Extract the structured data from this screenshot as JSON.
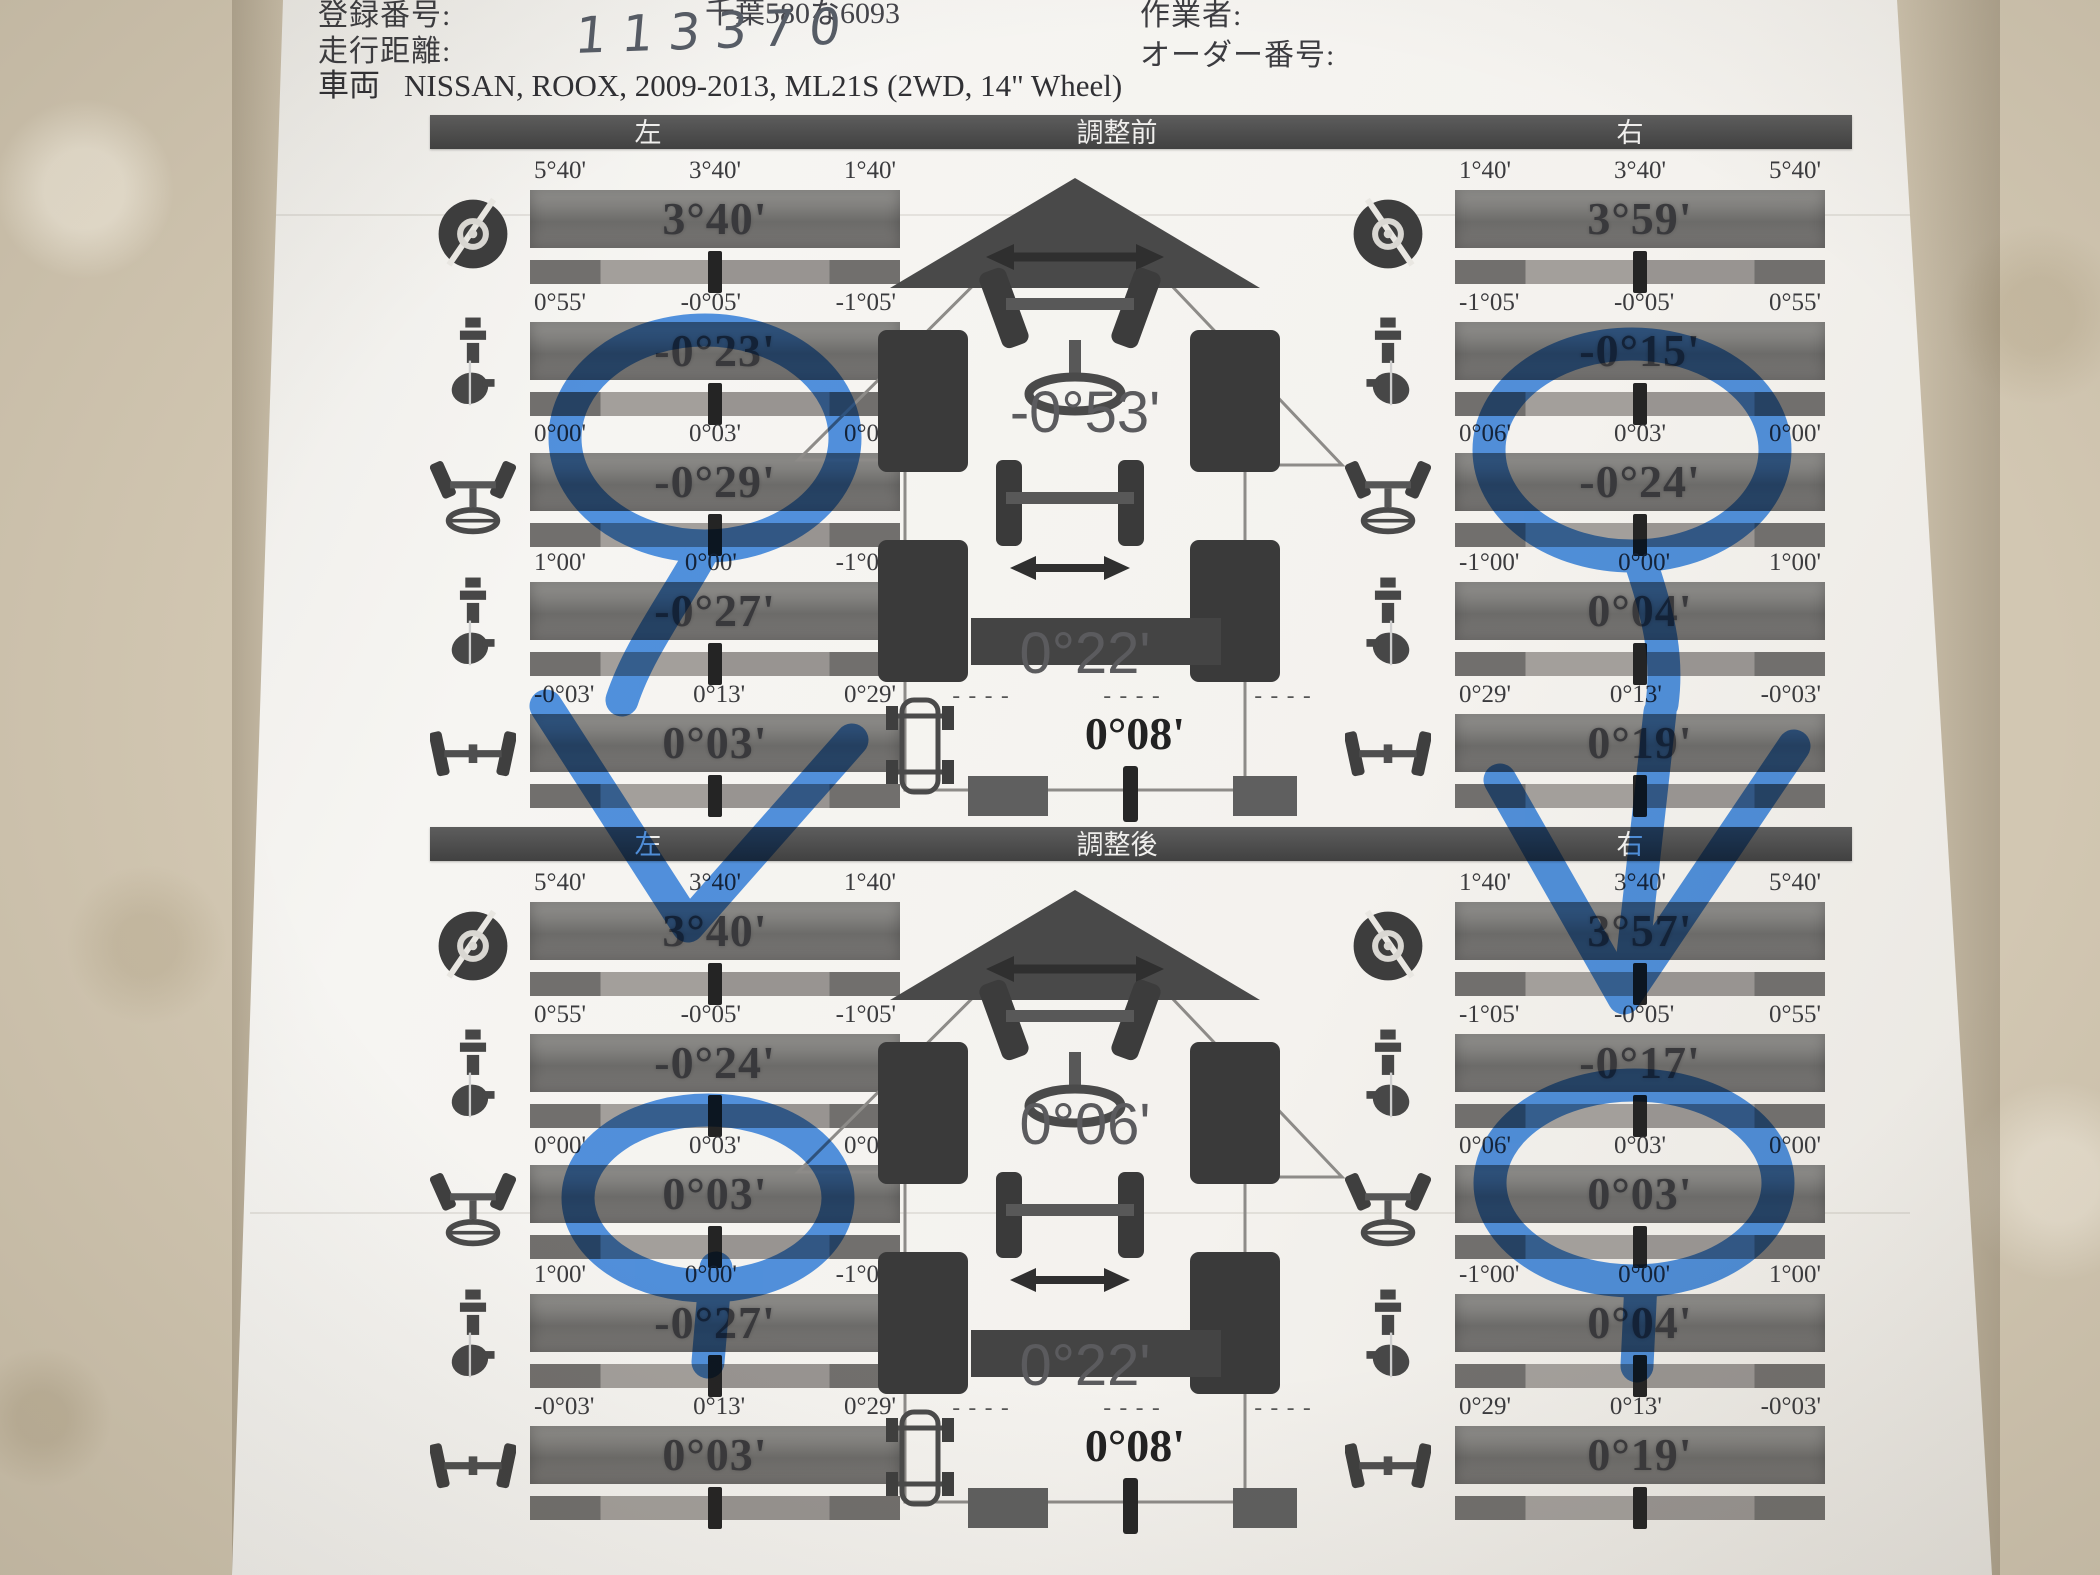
{
  "page": {
    "background_color": "#d2c7b2",
    "paper_color": "#f6f5f2",
    "annotation_color": "#2e7fe3"
  },
  "header": {
    "registration_label": "登録番号:",
    "registration_value": "千葉580な6093",
    "operator_label": "作業者:",
    "mileage_label": "走行距離:",
    "mileage_value": "113370",
    "order_label": "オーダー番号:",
    "vehicle_label": "車両",
    "vehicle_value": "NISSAN, ROOX, 2009-2013, ML21S (2WD, 14\" Wheel)"
  },
  "sections": [
    {
      "left_title": "左",
      "center_title": "調整前",
      "right_title": "右",
      "left_rows": [
        {
          "icon": "caster-icon",
          "ticks": [
            "5°40'",
            "3°40'",
            "1°40'"
          ],
          "value": "3°40'"
        },
        {
          "icon": "camber-icon",
          "ticks": [
            "0°55'",
            "-0°05'",
            "-1°05'"
          ],
          "value": "-0°23'"
        },
        {
          "icon": "toe-icon",
          "ticks": [
            "0°00'",
            "0°03'",
            "0°06'"
          ],
          "value": "-0°29'"
        },
        {
          "icon": "sai-icon",
          "ticks": [
            "1°00'",
            "0°00'",
            "-1°00'"
          ],
          "value": "-0°27'"
        },
        {
          "icon": "rear-toe-icon",
          "ticks": [
            "-0°03'",
            "0°13'",
            "0°29'"
          ],
          "value": "0°03'"
        }
      ],
      "right_rows": [
        {
          "icon": "caster-icon",
          "ticks": [
            "1°40'",
            "3°40'",
            "5°40'"
          ],
          "value": "3°59'"
        },
        {
          "icon": "camber-icon",
          "ticks": [
            "-1°05'",
            "-0°05'",
            "0°55'"
          ],
          "value": "-0°15'"
        },
        {
          "icon": "toe-icon",
          "ticks": [
            "0°06'",
            "0°03'",
            "0°00'"
          ],
          "value": "-0°24'"
        },
        {
          "icon": "sai-icon",
          "ticks": [
            "-1°00'",
            "0°00'",
            "1°00'"
          ],
          "value": "0°04'"
        },
        {
          "icon": "rear-toe-icon",
          "ticks": [
            "0°29'",
            "0°13'",
            "-0°03'"
          ],
          "value": "0°19'"
        }
      ],
      "center": {
        "front_value": "-0°53'",
        "rear_value": "0°22'",
        "thrust_value": "0°08'",
        "dash": "----"
      }
    },
    {
      "left_title": "左",
      "center_title": "調整後",
      "right_title": "右",
      "left_rows": [
        {
          "icon": "caster-icon",
          "ticks": [
            "5°40'",
            "3°40'",
            "1°40'"
          ],
          "value": "3°40'"
        },
        {
          "icon": "camber-icon",
          "ticks": [
            "0°55'",
            "-0°05'",
            "-1°05'"
          ],
          "value": "-0°24'"
        },
        {
          "icon": "toe-icon",
          "ticks": [
            "0°00'",
            "0°03'",
            "0°06'"
          ],
          "value": "0°03'"
        },
        {
          "icon": "sai-icon",
          "ticks": [
            "1°00'",
            "0°00'",
            "-1°00'"
          ],
          "value": "-0°27'"
        },
        {
          "icon": "rear-toe-icon",
          "ticks": [
            "-0°03'",
            "0°13'",
            "0°29'"
          ],
          "value": "0°03'"
        }
      ],
      "right_rows": [
        {
          "icon": "caster-icon",
          "ticks": [
            "1°40'",
            "3°40'",
            "5°40'"
          ],
          "value": "3°57'"
        },
        {
          "icon": "camber-icon",
          "ticks": [
            "-1°05'",
            "-0°05'",
            "0°55'"
          ],
          "value": "-0°17'"
        },
        {
          "icon": "toe-icon",
          "ticks": [
            "0°06'",
            "0°03'",
            "0°00'"
          ],
          "value": "0°03'"
        },
        {
          "icon": "sai-icon",
          "ticks": [
            "-1°00'",
            "0°00'",
            "1°00'"
          ],
          "value": "0°04'"
        },
        {
          "icon": "rear-toe-icon",
          "ticks": [
            "0°29'",
            "0°13'",
            "-0°03'"
          ],
          "value": "0°19'"
        }
      ],
      "center": {
        "front_value": "0°06'",
        "rear_value": "0°22'",
        "thrust_value": "0°08'",
        "dash": "----"
      }
    }
  ]
}
